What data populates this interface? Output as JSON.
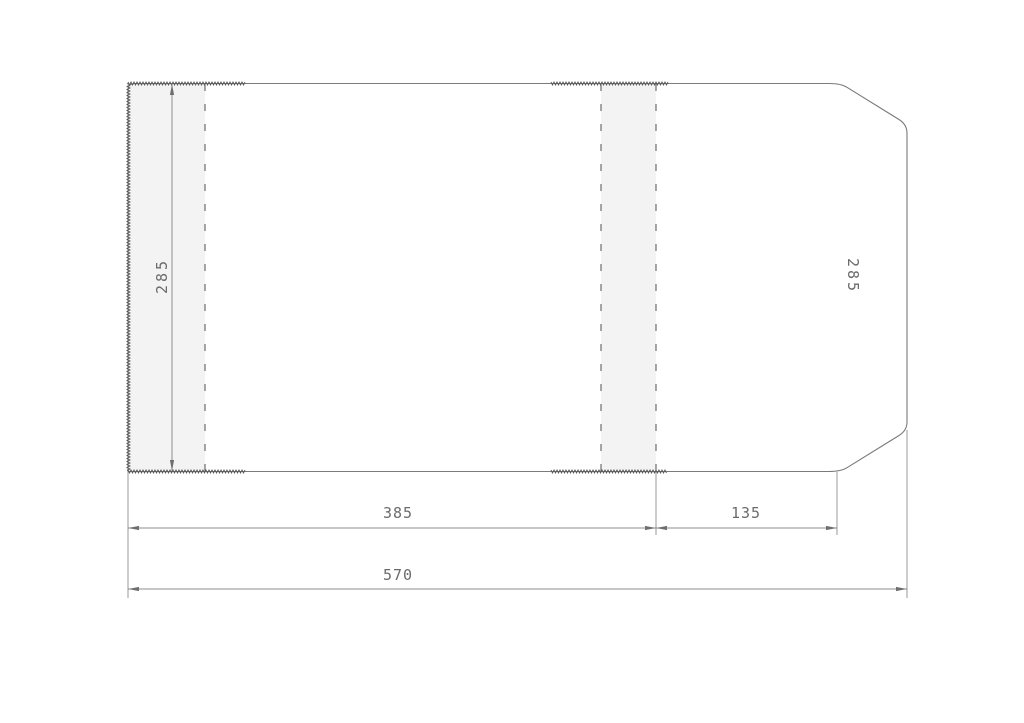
{
  "drawing_title": "cover-dieline-technical-drawing",
  "dimensions": {
    "height_left": {
      "value": "285",
      "orientation": "vertical"
    },
    "height_right": {
      "value": "285",
      "orientation": "vertical"
    },
    "width_main": {
      "value": "385",
      "orientation": "horizontal"
    },
    "width_flap": {
      "value": "135",
      "orientation": "horizontal"
    },
    "width_total": {
      "value": "570",
      "orientation": "horizontal"
    }
  },
  "colors": {
    "background": "#ffffff",
    "outline": "#7b7b7b",
    "dashed_fold_line": "#4f4f4f",
    "serrated_edge": "#585858",
    "dimension_line": "#8d8d8d",
    "arrow": "#6f6f6f",
    "band_fill": "#f3f3f3",
    "label_text": "#6b6b6b"
  },
  "geometry": {
    "canvas": {
      "w": 1024,
      "h": 723
    },
    "outline_path": "M128 90 Q128 83.5 135 83.5 L829 83.5 Q841 83.5 847 87.3 L899 119.5 Q907 124.5 907 133 L907 422 Q907 430.5 899 435.5 L847 467.7 Q841 471.5 829 471.5 L128 471.5 Z",
    "bands": [
      {
        "name": "fold-zone-left-flap",
        "x": 128.5,
        "y": 84,
        "w": 76.5,
        "h": 387.5
      },
      {
        "name": "fold-zone-spine",
        "x": 601,
        "y": 84,
        "w": 55,
        "h": 387.5
      }
    ],
    "dashed_lines": [
      {
        "name": "fold-line-left",
        "x1": 205,
        "y1": 84,
        "x2": 205,
        "y2": 471
      },
      {
        "name": "fold-line-spine-left",
        "x1": 601,
        "y1": 84,
        "x2": 601,
        "y2": 471
      },
      {
        "name": "fold-line-spine-right",
        "x1": 656,
        "y1": 84,
        "x2": 656,
        "y2": 471
      }
    ],
    "zigzag_edges": [
      {
        "name": "serrated-top-left",
        "x1": 128,
        "y1": 83.5,
        "x2": 245,
        "y2": 83.5
      },
      {
        "name": "serrated-top-middle",
        "x1": 551,
        "y1": 83.5,
        "x2": 668,
        "y2": 83.5
      },
      {
        "name": "serrated-bottom-left",
        "x1": 128,
        "y1": 471.5,
        "x2": 245,
        "y2": 471.5
      },
      {
        "name": "serrated-bottom-middle",
        "x1": 551,
        "y1": 471.5,
        "x2": 667,
        "y2": 471.5
      },
      {
        "name": "serrated-left-edge",
        "x1": 128.5,
        "y1": 83.5,
        "x2": 128.5,
        "y2": 471.5
      }
    ],
    "extension_lines": [
      {
        "x1": 128,
        "y1": 472,
        "x2": 128,
        "y2": 598
      },
      {
        "x1": 656,
        "y1": 472,
        "x2": 656,
        "y2": 535
      },
      {
        "x1": 837,
        "y1": 472,
        "x2": 837,
        "y2": 535
      },
      {
        "x1": 907,
        "y1": 430,
        "x2": 907,
        "y2": 598
      }
    ],
    "dimension_lines": [
      {
        "name": "dim-line-width-main",
        "x1": 128,
        "y1": 528,
        "x2": 656,
        "y2": 528
      },
      {
        "name": "dim-line-width-flap",
        "x1": 656,
        "y1": 528,
        "x2": 837,
        "y2": 528
      },
      {
        "name": "dim-line-width-total",
        "x1": 128,
        "y1": 589,
        "x2": 907,
        "y2": 589
      },
      {
        "name": "dim-line-height-left",
        "x1": 172,
        "y1": 84,
        "x2": 172,
        "y2": 471
      }
    ],
    "zigzag_style": {
      "period": 3,
      "amplitude": 1.5
    }
  }
}
